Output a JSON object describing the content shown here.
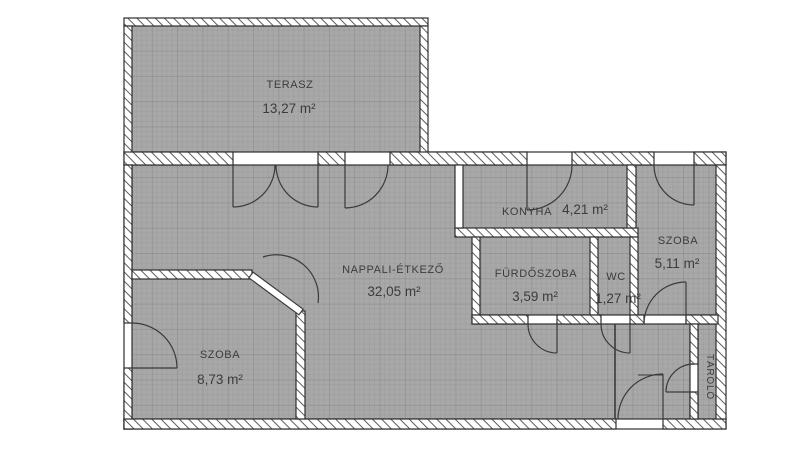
{
  "plan": {
    "colors": {
      "floor": "#a8a8a8",
      "wall_fill": "#ffffff",
      "wall_line": "#2e2e2e",
      "hatch_line": "#5f5f5f",
      "door_line": "#3a3a3a",
      "text": "#3c3c3c",
      "background": "#ffffff"
    },
    "rooms": {
      "terasz": {
        "name": "TERASZ",
        "area": "13,27 m²"
      },
      "nappali": {
        "name": "NAPPALI-ÉTKEZŐ",
        "area": "32,05 m²"
      },
      "konyha": {
        "name": "KONYHA",
        "area": "4,21 m²"
      },
      "szoba_jobb": {
        "name": "SZOBA",
        "area": "5,11 m²"
      },
      "furdoszoba": {
        "name": "FÜRDŐSZOBA",
        "area": "3,59 m²"
      },
      "wc": {
        "name": "WC",
        "area": "1,27 m²"
      },
      "szoba_bal": {
        "name": "SZOBA",
        "area": "8,73 m²"
      },
      "tarolo": {
        "name": "TÁROLÓ"
      }
    }
  }
}
